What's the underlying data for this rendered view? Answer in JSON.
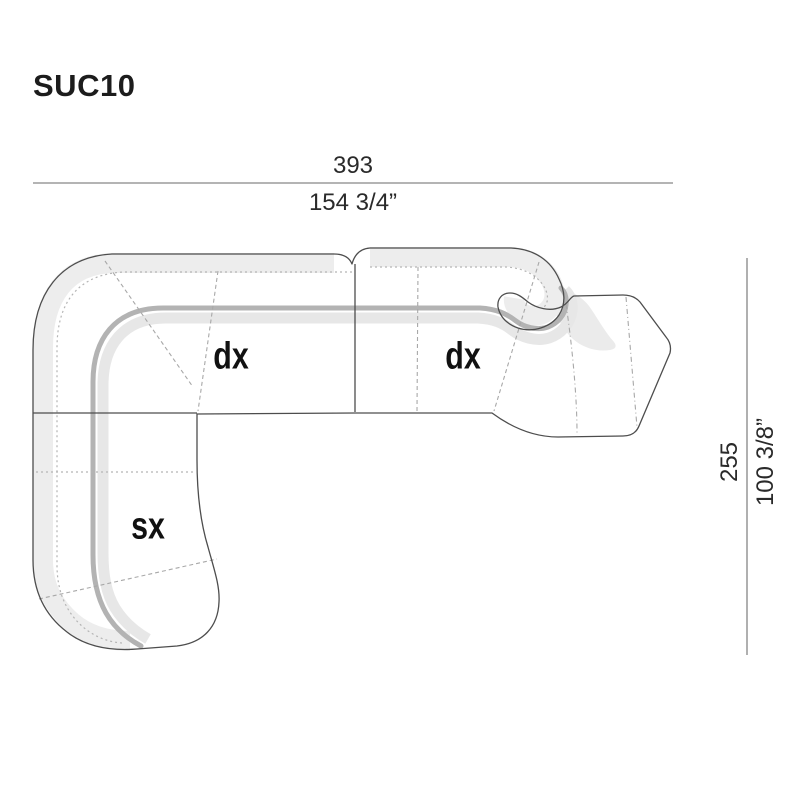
{
  "title": "SUC10",
  "dimensions": {
    "width": {
      "cm": "393",
      "inches": "154 3/4”"
    },
    "height": {
      "cm": "255",
      "inches": "100 3/8”"
    }
  },
  "modules": [
    {
      "label": "dx",
      "position": "center-seat"
    },
    {
      "label": "dx",
      "position": "right-seat"
    },
    {
      "label": "sx",
      "position": "left-chaise"
    }
  ],
  "colors": {
    "background": "#ffffff",
    "outline": "#4d4d4d",
    "dimension_line": "#9c9c9c",
    "backrest_band_light": "#ededed",
    "backrest_edge_dark": "#b3b3b3",
    "backrest_inner_light": "#e7e7e7",
    "shadow_spill": "#ebebeb",
    "seam_dashed": "#a8a8a8",
    "label_text": "#111111",
    "dimension_text": "#2a2a2a"
  }
}
